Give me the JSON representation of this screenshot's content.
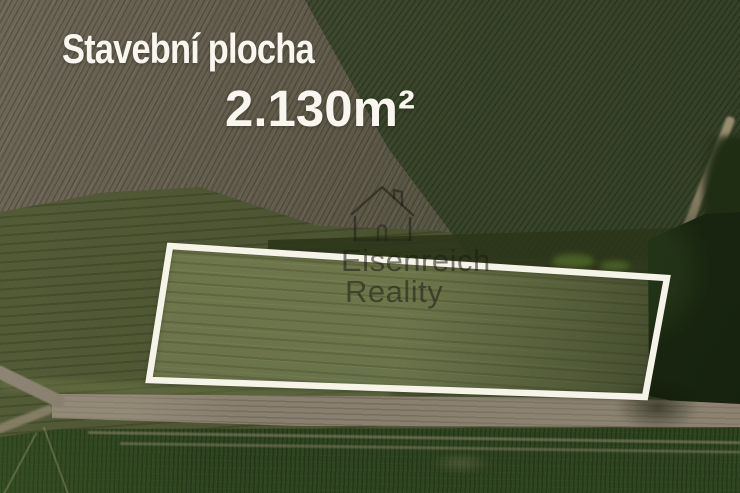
{
  "overlay": {
    "title": "Stavební plocha",
    "area": "2.130m²"
  },
  "watermark": {
    "icon": "house-outline-icon",
    "line1": "Eisenreich",
    "line2": "Reality"
  },
  "plot_boundary": {
    "points": "170,246 667,278 645,397 149,380"
  },
  "colors": {
    "title_white": "#f8f6ef",
    "boundary_white": "#f6f3e9",
    "watermark": "rgba(28,28,20,0.55)",
    "plowed_light": "#6e6758",
    "plowed_mid": "#5c5847",
    "green_field": "#39452a",
    "meadow": "#4c5432",
    "scrub_dark": "#2c3519",
    "plot_base": "#6e774b",
    "trees_dark": "#1a2711",
    "road_tan": "#8f8678",
    "bottom_field": "#2f4420",
    "track_light": "#a39781"
  }
}
